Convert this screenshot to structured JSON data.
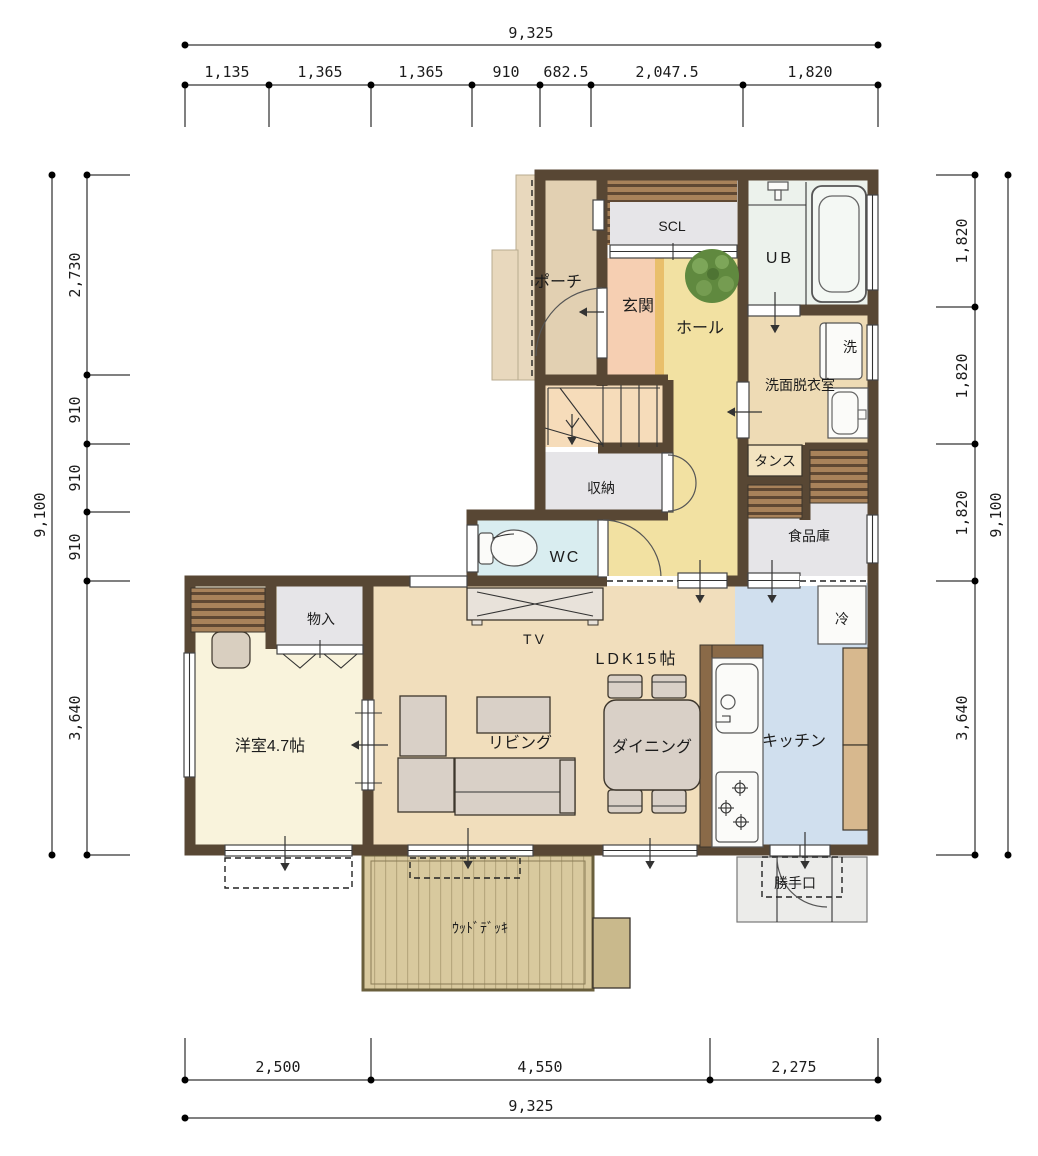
{
  "floorplan": {
    "rooms": {
      "scl": "SCL",
      "porch": "ポーチ",
      "genkan": "玄関",
      "hall": "ホール",
      "ub": "UB",
      "washer": "洗",
      "washroom": "洗面脱衣室",
      "tansu": "タンス",
      "storage": "収納",
      "wc": "WC",
      "pantry": "食品庫",
      "monoire": "物入",
      "tv": "TV",
      "ldk": "LDK15帖",
      "fridge": "冷",
      "western_room": "洋室4.7帖",
      "living": "リビング",
      "dining": "ダイニング",
      "kitchen": "キッチン",
      "back_door": "勝手口",
      "wood_deck": "ｳｯﾄﾞﾃﾞｯｷ"
    },
    "dimensions": {
      "top": {
        "total": "9,325",
        "segments": [
          "1,135",
          "1,365",
          "1,365",
          "910",
          "682.5",
          "2,047.5",
          "1,820"
        ]
      },
      "bottom": {
        "total": "9,325",
        "segments": [
          "2,500",
          "4,550",
          "2,275"
        ]
      },
      "left": {
        "total": "9,100",
        "segments": [
          "2,730",
          "910",
          "910",
          "910",
          "3,640"
        ]
      },
      "right": {
        "total": "9,100",
        "segments": [
          "1,820",
          "1,820",
          "1,820",
          "3,640"
        ]
      }
    },
    "colors": {
      "wall": "#584734",
      "ldk_floor": "#f1debc",
      "kitchen_floor": "#d0dfee",
      "hall_floor": "#f2e1a2",
      "genkan_floor": "#f6cfb2",
      "porch_floor": "#e2d0b2",
      "ub_floor": "#ecf2ec",
      "wc_floor": "#d9edf0",
      "washroom_floor": "#eedbb5",
      "western_room_floor": "#f9f3dc",
      "closet_gray": "#e6e5e8",
      "stairs_floor": "#f6dcba",
      "deck": "#d8c99e",
      "wood_hatch": "#a8825a",
      "step_accent": "#e9bf6b",
      "plant_green": "#60893f"
    }
  }
}
